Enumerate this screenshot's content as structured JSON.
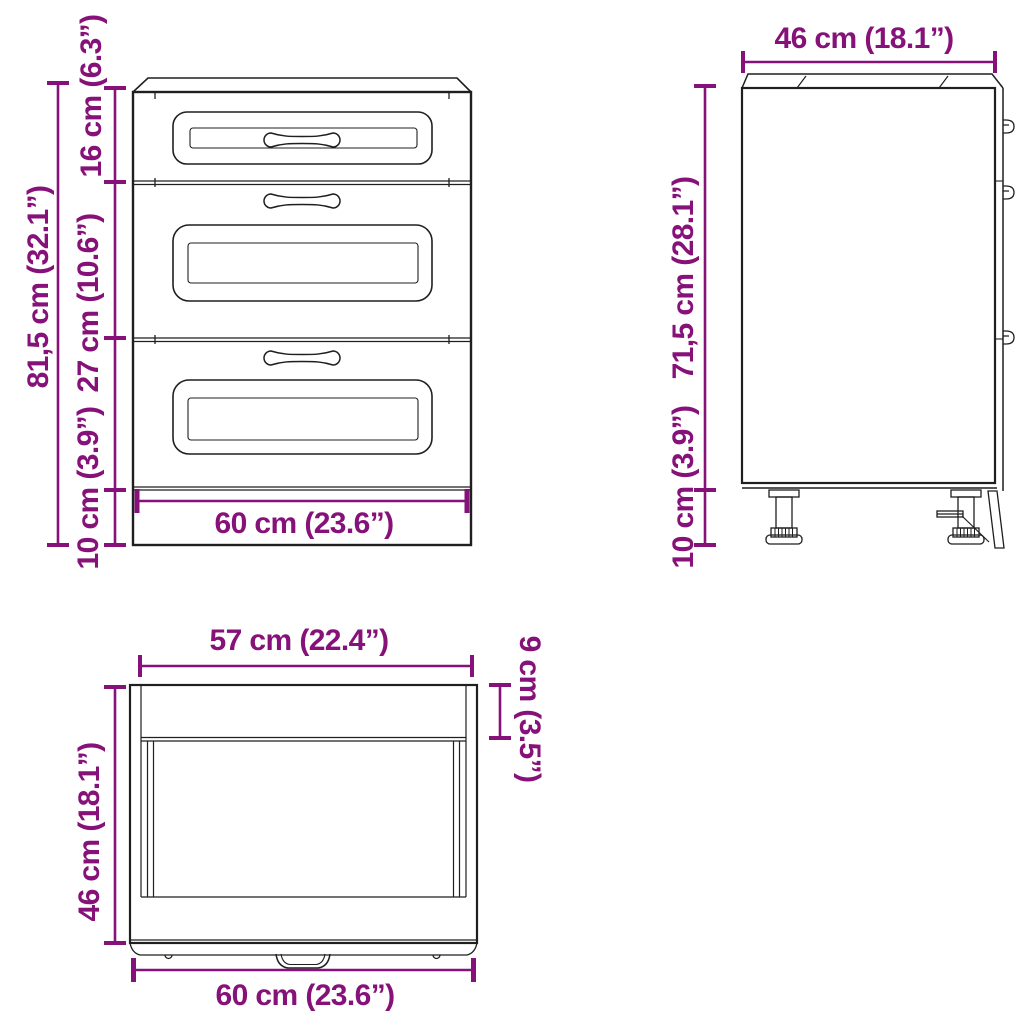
{
  "colors": {
    "dimension": "#861179",
    "line": "#1f1f1f",
    "background": "#ffffff"
  },
  "views": {
    "front": {
      "title": "front view of 3-drawer base cabinet",
      "dims": {
        "total_height": "81,5 cm (32.1”)",
        "top_drawer_height": "16 cm (6.3”)",
        "middle_drawer_height": "27 cm (10.6”)",
        "leg_height": "10 cm (3.9”)",
        "width": "60 cm (23.6”)"
      }
    },
    "side": {
      "title": "side view of cabinet",
      "dims": {
        "depth": "46 cm (18.1”)",
        "body_height": "71,5 cm (28.1”)",
        "leg_height": "10 cm (3.9”)"
      }
    },
    "top": {
      "title": "top view of cabinet",
      "dims": {
        "inner_width": "57 cm (22.4”)",
        "top_strip_depth": "9 cm (3.5”)",
        "depth": "46 cm (18.1”)",
        "width": "60 cm (23.6”)"
      }
    }
  }
}
